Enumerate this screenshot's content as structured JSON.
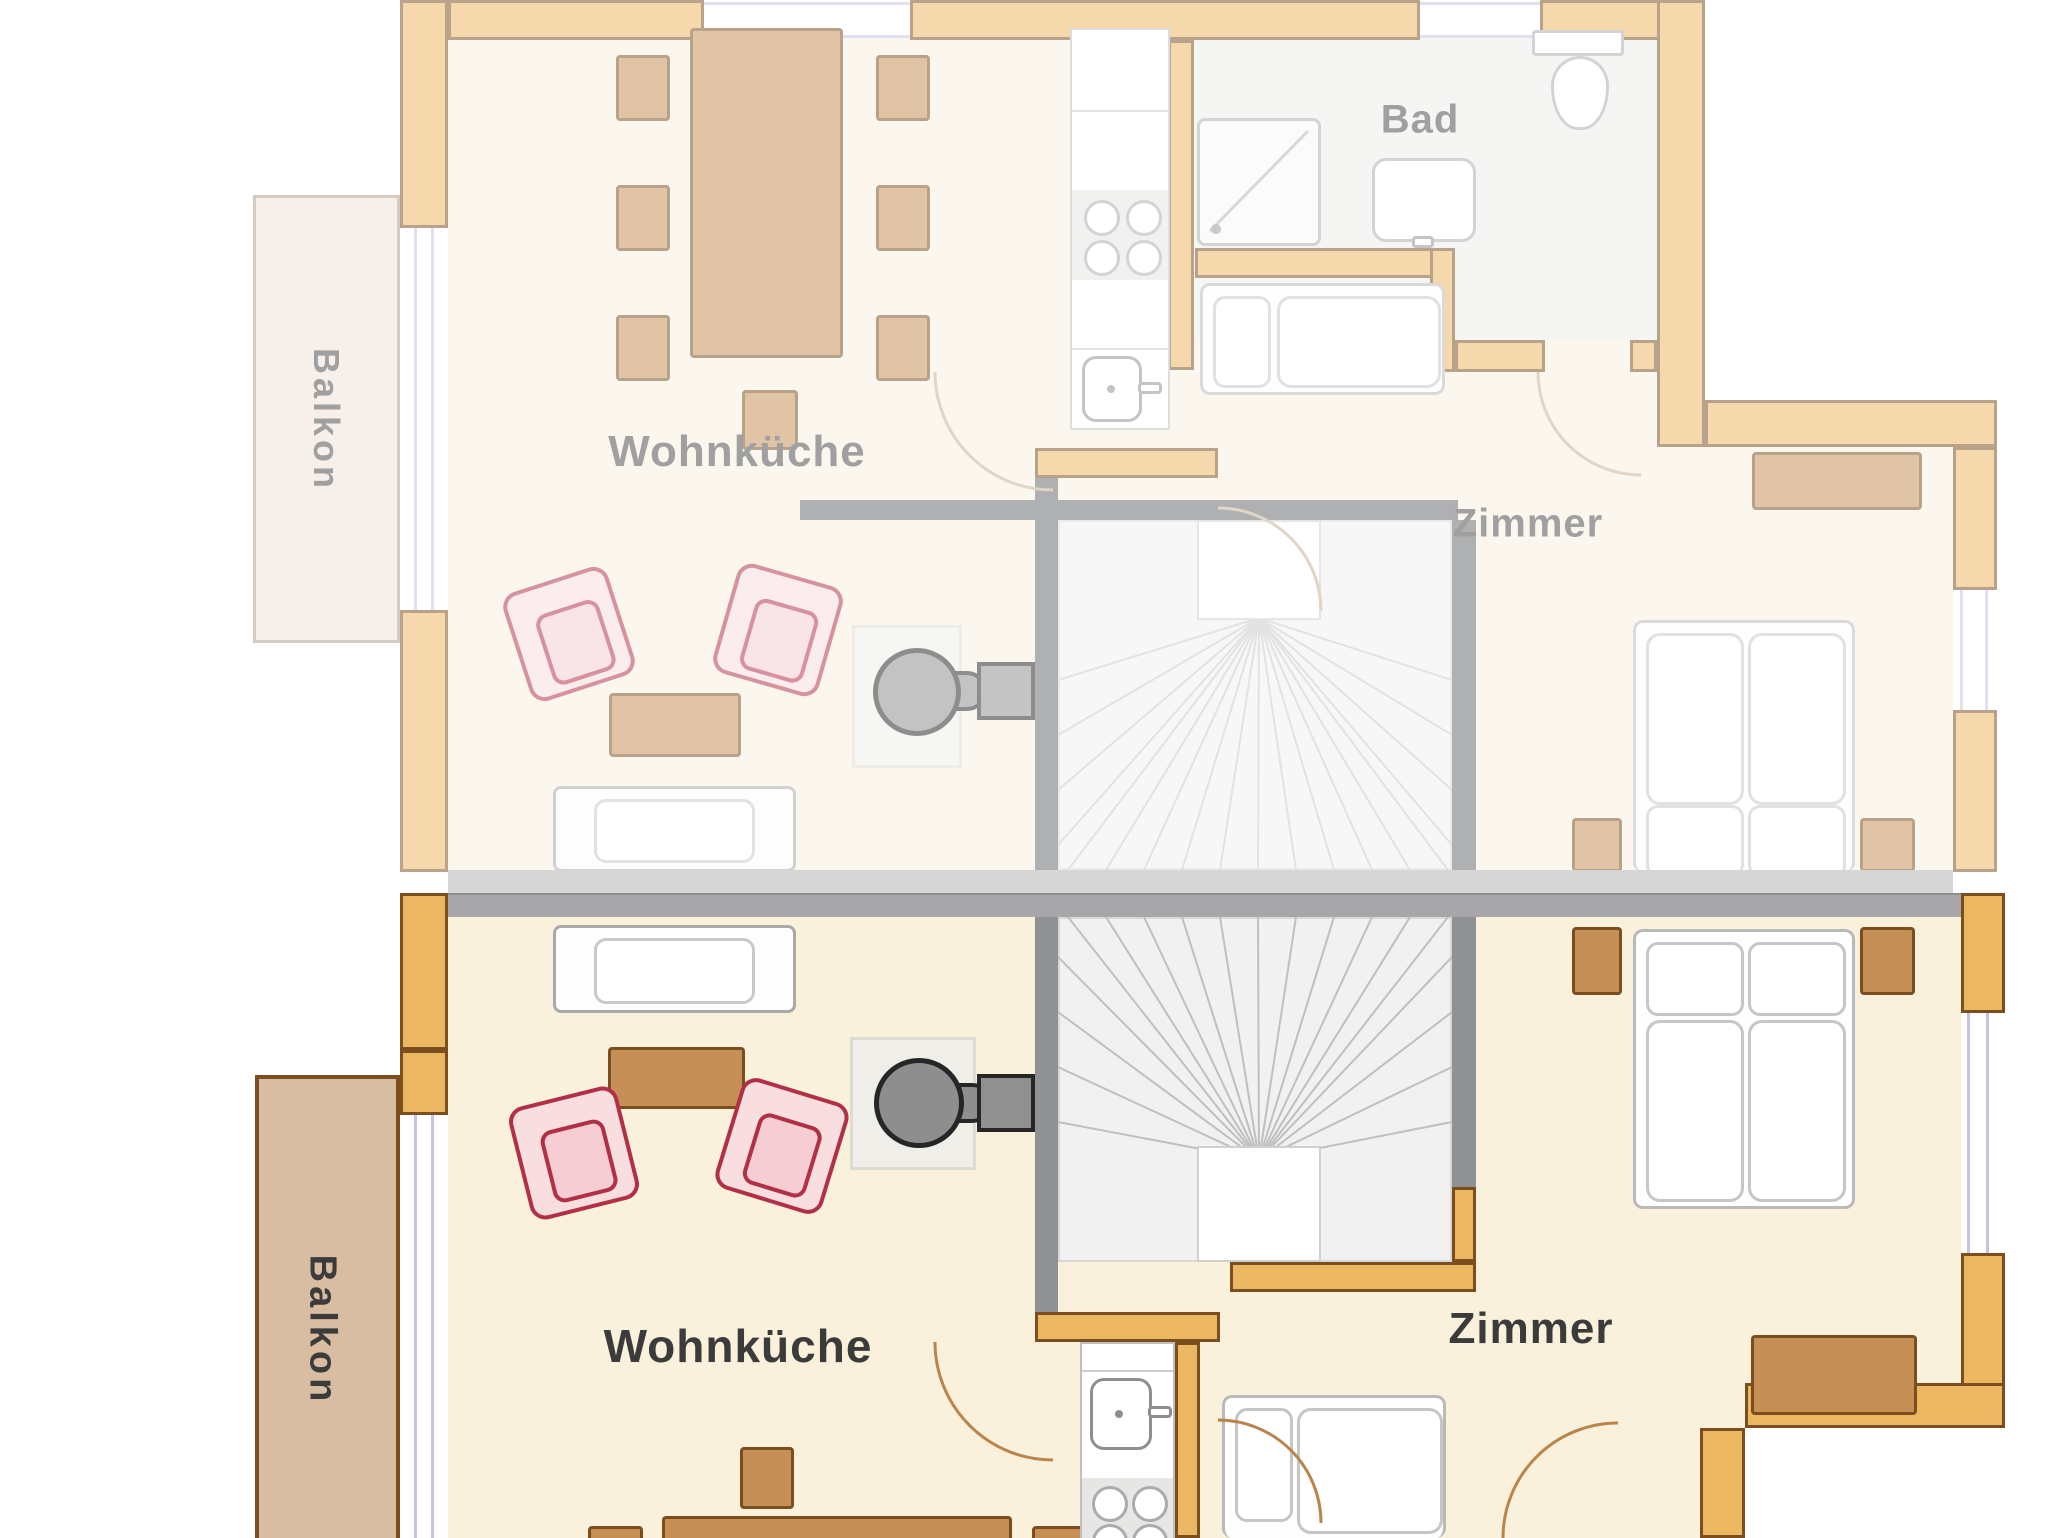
{
  "title": "Wohnungsgrundriss – Maisonette (zwei Ebenen)",
  "labels": {
    "upper_balcony": "Balkon",
    "upper_living": "Wohnküche",
    "upper_bath": "Bad",
    "upper_room": "Zimmer",
    "lower_balcony": "Balkon",
    "lower_living": "Wohnküche",
    "lower_room": "Zimmer"
  },
  "floors": {
    "upper": {
      "state": "inactive-faded",
      "rooms": [
        "Balkon",
        "Wohnküche",
        "Bad",
        "Zimmer"
      ],
      "furniture": [
        "dining-table",
        "six-chairs",
        "extra-chair",
        "kitchen-counter",
        "cooktop-4-burners",
        "kitchen-sink",
        "shower",
        "bathroom-sink",
        "toilet",
        "single-bed",
        "double-bed",
        "two-nightstands",
        "dresser",
        "sofa",
        "two-armchairs",
        "coffee-table",
        "wood-stove",
        "winder-staircase"
      ]
    },
    "lower": {
      "state": "active",
      "rooms": [
        "Balkon",
        "Wohnküche",
        "Zimmer"
      ],
      "furniture": [
        "sofa",
        "two-armchairs",
        "coffee-table",
        "wood-stove",
        "dining-table",
        "three-chairs",
        "kitchen-counter",
        "cooktop-4-burners",
        "kitchen-sink",
        "single-bed",
        "double-bed",
        "two-nightstands",
        "dresser",
        "winder-staircase"
      ]
    }
  },
  "colors": {
    "wall_active": "#ECB761",
    "wall_border": "#7B4E20",
    "stair_wall": "#8F9193",
    "divider_light": "#D6D6D6",
    "divider_dark": "#A7A7A9",
    "floor_cream": "#FAF1DC",
    "bath_floor": "#EDEEEA",
    "window_glass": "#C6C2E4",
    "armchair_red": "#B23046",
    "furniture_wood": "#C68F55",
    "balcony_lower": "#D8BDA2",
    "balcony_upper": "#EFE1D8",
    "label_text": "#3B3B3B"
  }
}
